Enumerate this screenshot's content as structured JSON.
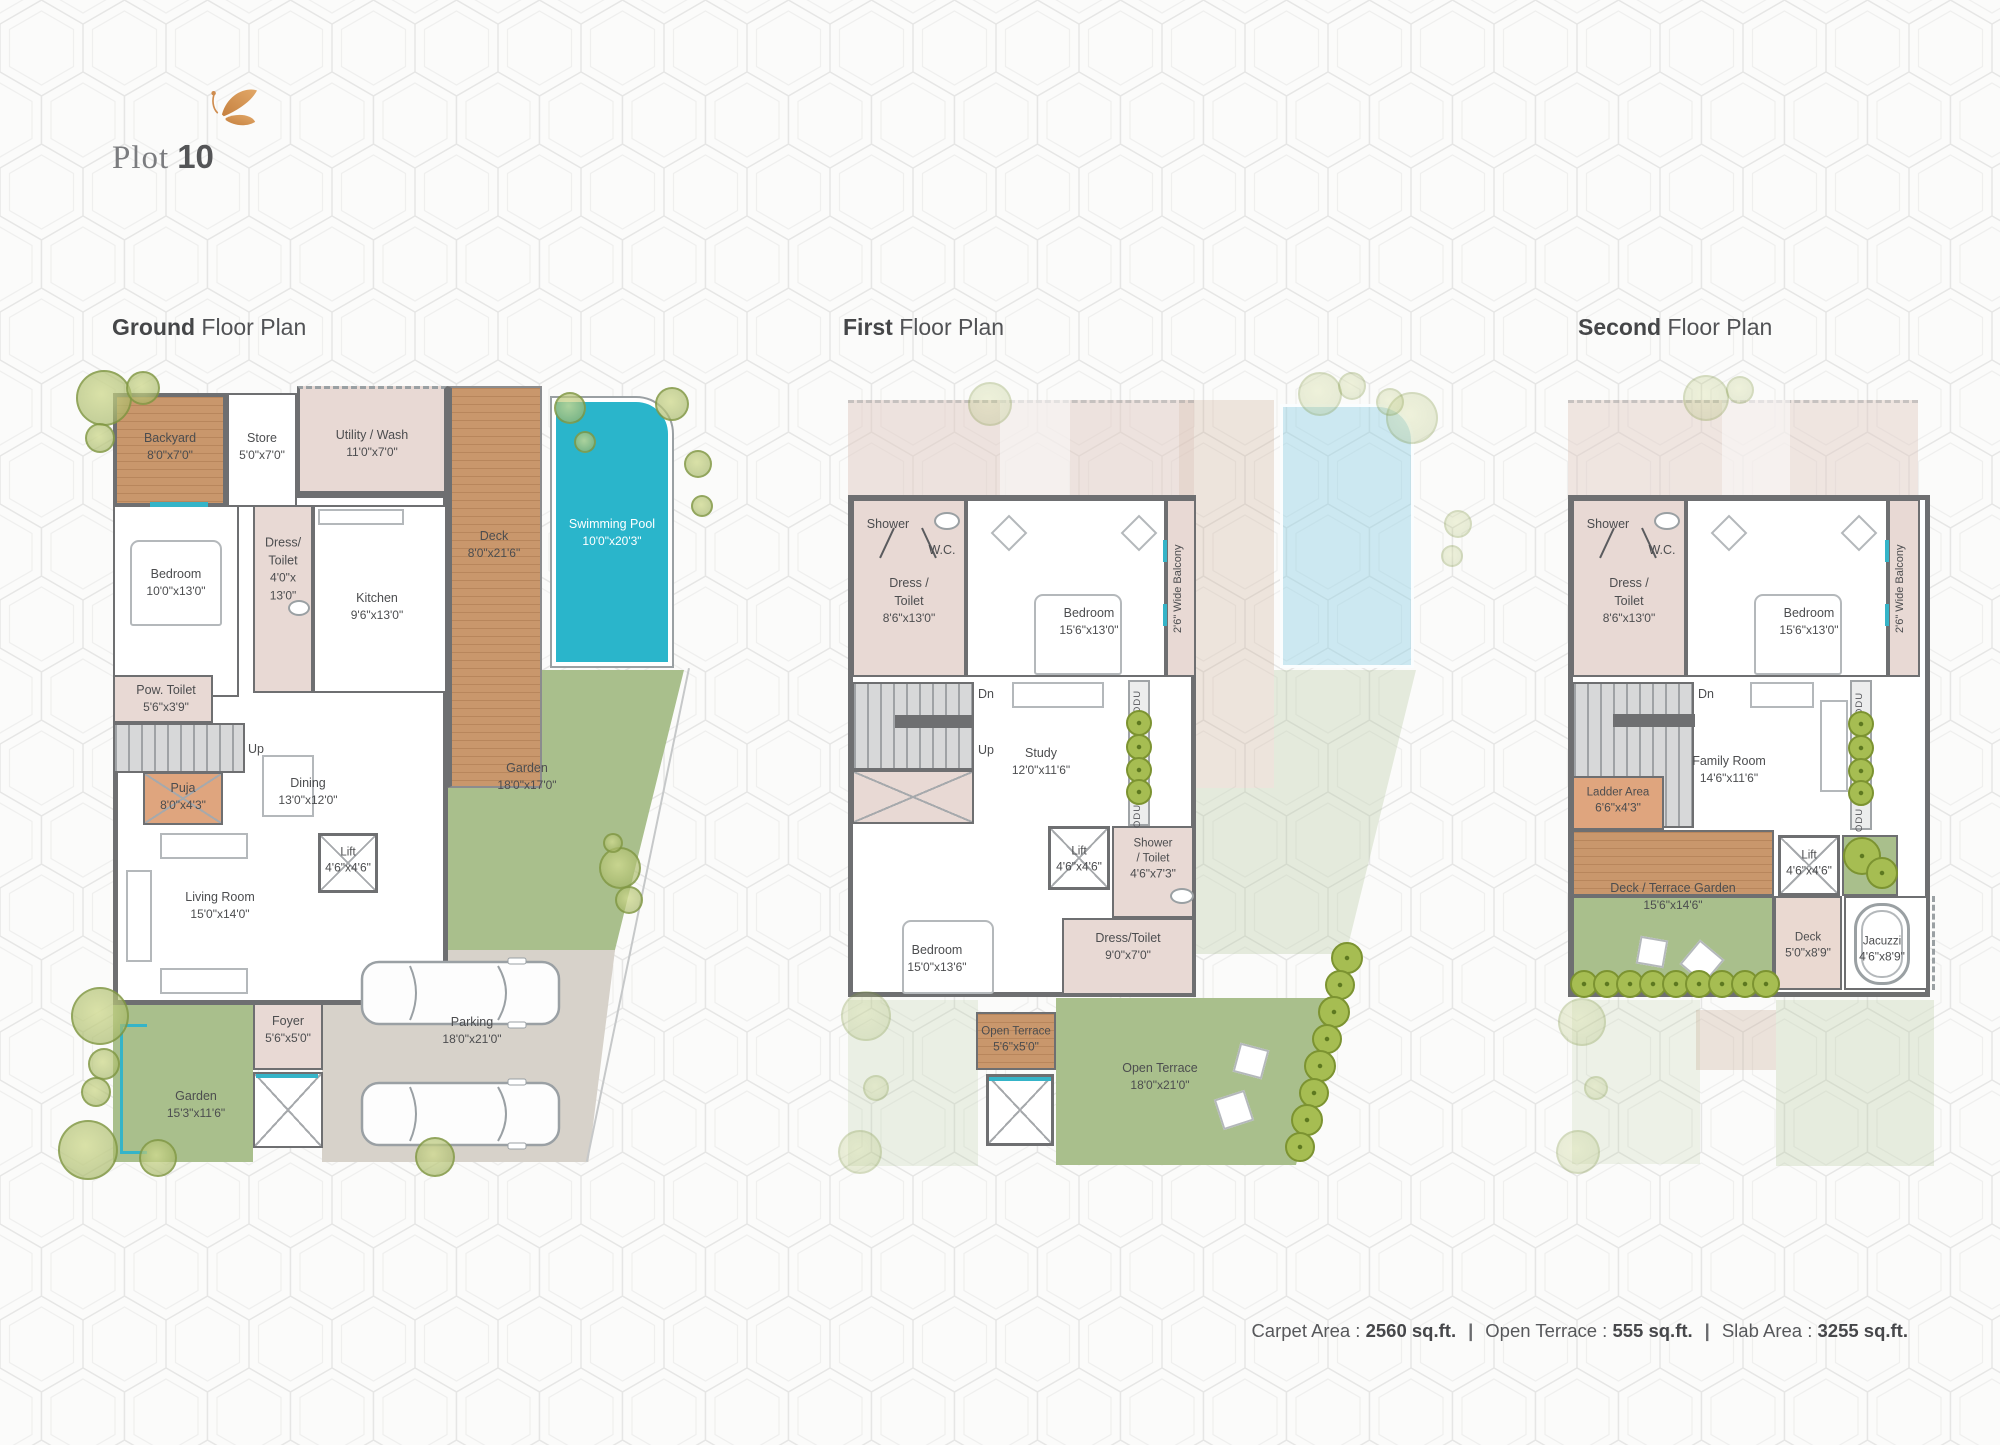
{
  "header": {
    "brand_word": "Plot",
    "brand_number": "10"
  },
  "footer": {
    "carpet_label": "Carpet Area :",
    "carpet_value": "2560 sq.ft.",
    "sep": "|",
    "terrace_label": "Open Terrace :",
    "terrace_value": "555 sq.ft.",
    "slab_label": "Slab Area :",
    "slab_value": "3255 sq.ft."
  },
  "g": {
    "title_bold": "Ground",
    "title_rest": " Floor Plan",
    "backyard": {
      "n": "Backyard",
      "d": "8'0\"x7'0\""
    },
    "store": {
      "n": "Store",
      "d": "5'0\"x7'0\""
    },
    "utility": {
      "n": "Utility / Wash",
      "d": "11'0\"x7'0\""
    },
    "deck": {
      "n": "Deck",
      "d": "8'0\"x21'6\""
    },
    "pool": {
      "n": "Swimming Pool",
      "d": "10'0\"x20'3\""
    },
    "bedroom": {
      "n": "Bedroom",
      "d": "10'0\"x13'0\""
    },
    "dress": {
      "n1": "Dress/",
      "n2": "Toilet",
      "d1": "4'0\"x",
      "d2": "13'0\""
    },
    "kitchen": {
      "n": "Kitchen",
      "d": "9'6\"x13'0\""
    },
    "pow": {
      "n": "Pow. Toilet",
      "d": "5'6\"x3'9\""
    },
    "up": "Up",
    "puja": {
      "n": "Puja",
      "d": "8'0\"x4'3\""
    },
    "dining": {
      "n": "Dining",
      "d": "13'0\"x12'0\""
    },
    "lift": {
      "n": "Lift",
      "d": "4'6\"x4'6\""
    },
    "living": {
      "n": "Living Room",
      "d": "15'0\"x14'0\""
    },
    "garden_r": {
      "n": "Garden",
      "d": "18'0\"x17'0\""
    },
    "foyer": {
      "n": "Foyer",
      "d": "5'6\"x5'0\""
    },
    "parking": {
      "n": "Parking",
      "d": "18'0\"x21'0\""
    },
    "garden_l": {
      "n": "Garden",
      "d": "15'3\"x11'6\""
    }
  },
  "f": {
    "title_bold": "First",
    "title_rest": " Floor Plan",
    "shower": "Shower",
    "wc": "W.C.",
    "dress": {
      "n1": "Dress /",
      "n2": "Toilet",
      "d": "8'6\"x13'0\""
    },
    "bedroom": {
      "n": "Bedroom",
      "d": "15'6\"x13'0\""
    },
    "balcony": "2'6\" Wide Balcony",
    "dn": "Dn",
    "up": "Up",
    "study": {
      "n": "Study",
      "d": "12'0\"x11'6\""
    },
    "odu": "ODU",
    "lift": {
      "n": "Lift",
      "d": "4'6\"x4'6\""
    },
    "shower_toilet": {
      "n1": "Shower",
      "n2": "/ Toilet",
      "d": "4'6\"x7'3\""
    },
    "dress2": {
      "n": "Dress/Toilet",
      "d": "9'0\"x7'0\""
    },
    "bedroom2": {
      "n": "Bedroom",
      "d": "15'0\"x13'6\""
    },
    "terrace_s": {
      "n": "Open Terrace",
      "d": "5'6\"x5'0\""
    },
    "terrace_b": {
      "n": "Open Terrace",
      "d": "18'0\"x21'0\""
    }
  },
  "s": {
    "title_bold": "Second",
    "title_rest": " Floor Plan",
    "shower": "Shower",
    "wc": "W.C.",
    "dress": {
      "n1": "Dress /",
      "n2": "Toilet",
      "d": "8'6\"x13'0\""
    },
    "bedroom": {
      "n": "Bedroom",
      "d": "15'6\"x13'0\""
    },
    "balcony": "2'6\" Wide Balcony",
    "dn": "Dn",
    "family": {
      "n": "Family Room",
      "d": "14'6\"x11'6\""
    },
    "odu": "ODU",
    "ladder": {
      "n": "Ladder Area",
      "d": "6'6\"x4'3\""
    },
    "deck_terrace": {
      "n": "Deck / Terrace Garden",
      "d": "15'6\"x14'6\""
    },
    "lift": {
      "n": "Lift",
      "d": "4'6\"x4'6\""
    },
    "deck": {
      "n": "Deck",
      "d": "5'0\"x8'9\""
    },
    "jacuzzi": {
      "n": "Jacuzzi",
      "d": "4'6\"x8'9\""
    }
  },
  "colors": {
    "wall": "#6e6f71",
    "pool": "#2ab5cb",
    "garden": "#a9bf8c",
    "wood": "#c9976c",
    "room_pink": "#e8d9d4",
    "accent_orange": "#cf8c4e",
    "parking_gray": "#d7d2ca",
    "text": "#4c4d4f"
  }
}
